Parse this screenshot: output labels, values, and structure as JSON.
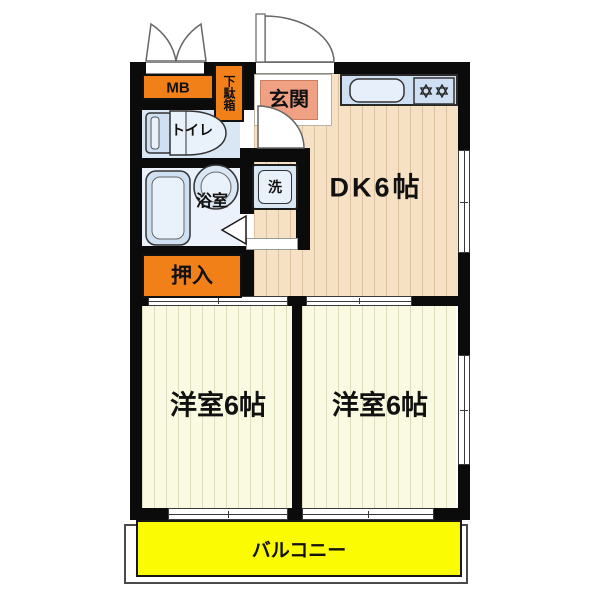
{
  "plan": {
    "type": "apartment-floor-plan",
    "labels": {
      "mb": "MB",
      "shoe_cabinet": "下駄箱",
      "entrance": "玄関",
      "toilet": "トイレ",
      "bathroom": "浴室",
      "washer": "洗",
      "dining_kitchen": "DK6帖",
      "closet": "押入",
      "bedroom_left": "洋室6帖",
      "bedroom_right": "洋室6帖",
      "balcony": "バルコニー"
    },
    "colors": {
      "wall": "#0b0b0b",
      "accent_orange": "#F28018",
      "entrance_salmon": "#F0A183",
      "balcony_yellow": "#FBFB04",
      "floor_wood": "#F6E1C4",
      "floor_cream": "#FAF9E2",
      "fixture_blue": "#CFE0F2",
      "room_blue": "#D9E6F4",
      "bath_floor": "#EBF2FB"
    }
  }
}
